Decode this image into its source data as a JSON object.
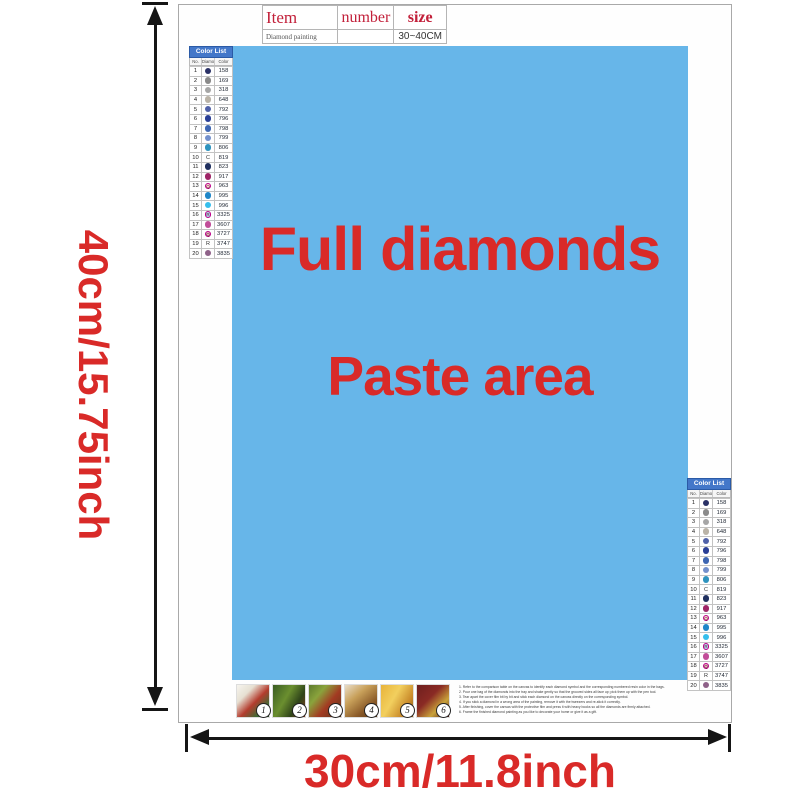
{
  "dimension_labels": {
    "height": "40cm/15.75inch",
    "width": "30cm/11.8inch"
  },
  "canvas": {
    "line1": "Full diamonds",
    "line2": "Paste area",
    "bg_color": "#67b6e9",
    "text_color": "#d92a28"
  },
  "item_table": {
    "col_item": "Item",
    "col_number": "number",
    "col_size": "size",
    "product_name": "Diamond painting",
    "number_value": "",
    "size_value": "30~40CM",
    "header_color": "#c2203a"
  },
  "color_list": {
    "title": "Color List",
    "col_no": "No.",
    "col_diamond": "Diamond",
    "col_color": "Color",
    "header_bg": "#4377c9",
    "rows": [
      {
        "no": "1",
        "code": "158",
        "hex": "#2a3166",
        "kind": "dot",
        "glyph": ""
      },
      {
        "no": "2",
        "code": "169",
        "hex": "#8a8a8a",
        "kind": "dot",
        "glyph": ""
      },
      {
        "no": "3",
        "code": "318",
        "hex": "#a6a6a6",
        "kind": "dot",
        "glyph": ""
      },
      {
        "no": "4",
        "code": "648",
        "hex": "#bab3a7",
        "kind": "dot",
        "glyph": ""
      },
      {
        "no": "5",
        "code": "792",
        "hex": "#5061a8",
        "kind": "dot",
        "glyph": ""
      },
      {
        "no": "6",
        "code": "796",
        "hex": "#2a3f96",
        "kind": "dot",
        "glyph": ""
      },
      {
        "no": "7",
        "code": "798",
        "hex": "#3e66b2",
        "kind": "dot",
        "glyph": ""
      },
      {
        "no": "8",
        "code": "799",
        "hex": "#7390cc",
        "kind": "dot",
        "glyph": ""
      },
      {
        "no": "9",
        "code": "806",
        "hex": "#2e93be",
        "kind": "dot",
        "glyph": ""
      },
      {
        "no": "10",
        "code": "819",
        "hex": "#f4dede",
        "kind": "letter",
        "glyph": "C"
      },
      {
        "no": "11",
        "code": "823",
        "hex": "#20305f",
        "kind": "dot",
        "glyph": ""
      },
      {
        "no": "12",
        "code": "917",
        "hex": "#9e2566",
        "kind": "dot",
        "glyph": ""
      },
      {
        "no": "13",
        "code": "963",
        "hex": "#f6d2ce",
        "kind": "ring",
        "glyph": "Q"
      },
      {
        "no": "14",
        "code": "995",
        "hex": "#1f86c8",
        "kind": "dot",
        "glyph": ""
      },
      {
        "no": "15",
        "code": "996",
        "hex": "#35beec",
        "kind": "dot",
        "glyph": ""
      },
      {
        "no": "16",
        "code": "3325",
        "hex": "#aecfe9",
        "kind": "ring",
        "glyph": "R"
      },
      {
        "no": "17",
        "code": "3607",
        "hex": "#c14e99",
        "kind": "dot",
        "glyph": ""
      },
      {
        "no": "18",
        "code": "3727",
        "hex": "#e0aebc",
        "kind": "ring",
        "glyph": "Q"
      },
      {
        "no": "19",
        "code": "3747",
        "hex": "#d3d7ec",
        "kind": "letter",
        "glyph": "R"
      },
      {
        "no": "20",
        "code": "3835",
        "hex": "#8f6289",
        "kind": "dot",
        "glyph": ""
      }
    ]
  },
  "instruction_strip": {
    "steps": [
      {
        "num": "1",
        "gradient": "linear-gradient(135deg,#f6f4ee 0%,#e6e0d2 28%,#b43c2e 55%,#3e6b34 80%,#2e4d26 100%)"
      },
      {
        "num": "2",
        "gradient": "linear-gradient(120deg,#3a5c22 0%,#6b8f2f 40%,#2f4419 70%,#8a3b1e 100%)"
      },
      {
        "num": "3",
        "gradient": "linear-gradient(130deg,#5d7a2c 0%,#8aa33c 30%,#a33b22 60%,#5c3418 100%)"
      },
      {
        "num": "4",
        "gradient": "linear-gradient(140deg,#e9ddc8 0%,#c8a05a 35%,#8a5a28 70%,#5e3a1a 100%)"
      },
      {
        "num": "5",
        "gradient": "linear-gradient(120deg,#e8b33a 0%,#f2cf5e 40%,#c98a2a 75%,#8a5e1e 100%)"
      },
      {
        "num": "6",
        "gradient": "linear-gradient(135deg,#6e1f1e 0%,#8a2a24 40%,#c9a23a 70%,#4e1714 100%)"
      }
    ],
    "text_lines": [
      "1. Refer to the comparison table on the canvas to identify each diamond symbol and the corresponding numbered resin color in the bags.",
      "2. Pour one bag of the diamonds into the tray and shake gently so that the grooved sides all face up; pick them up with the pen tool.",
      "3. Tear apart the cover film bit by bit and stick each diamond on the canvas directly on the corresponding symbol.",
      "4. If you stick a diamond in a wrong area of the painting, remove it with the tweezers and re-stick it correctly.",
      "5. After finishing, cover the canvas with the protective film and press it with heavy books so all the diamonds are firmly attached.",
      "6. Frame the finished diamond painting as you like to decorate your home or give it as a gift."
    ]
  },
  "colors": {
    "accent_red": "#d92a28",
    "arrow_black": "#151515",
    "sheet_border": "#a9a9a9"
  }
}
